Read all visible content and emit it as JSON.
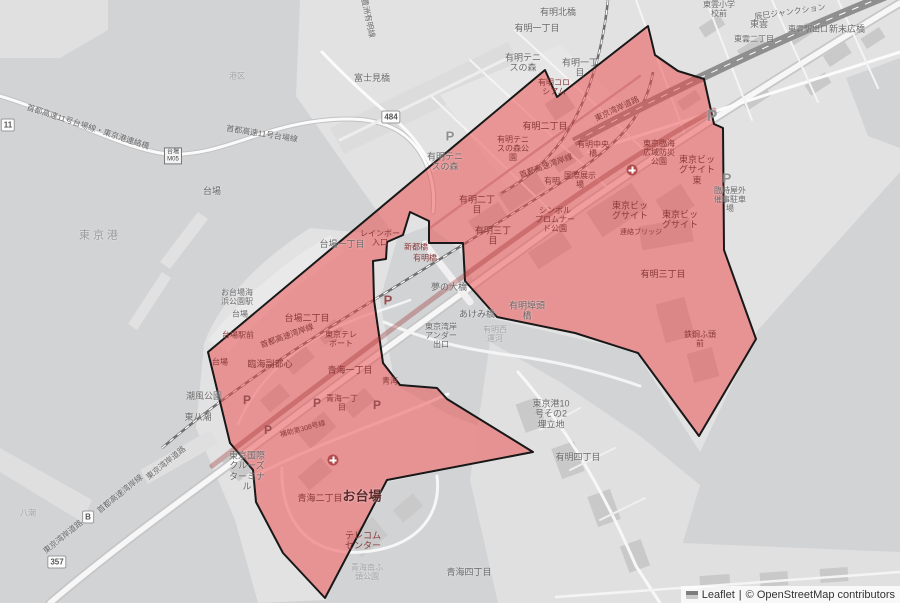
{
  "attribution": {
    "leaflet": "Leaflet",
    "sep": "|",
    "osm": "© OpenStreetMap contributors"
  },
  "highlight_color": "#eb4b4b",
  "labels": [
    {
      "t": "首都高速11号台場線・東京港連絡橋",
      "x": 88,
      "y": 127,
      "s": 8,
      "c": "g",
      "rot": 18
    },
    {
      "t": "首都高速11号台場線",
      "x": 262,
      "y": 134,
      "s": 8,
      "c": "g",
      "rot": 9
    },
    {
      "t": "豊洲有明線",
      "x": 368,
      "y": 18,
      "s": 8,
      "c": "g",
      "rot": 78
    },
    {
      "t": "富士見橋",
      "x": 372,
      "y": 78,
      "s": 9,
      "c": "g"
    },
    {
      "t": "有明北橋",
      "x": 558,
      "y": 12,
      "s": 9,
      "c": "g"
    },
    {
      "t": "有明一丁目",
      "x": 537,
      "y": 28,
      "s": 9,
      "c": "g"
    },
    {
      "t": "有明一丁\n目",
      "x": 580,
      "y": 68,
      "s": 9,
      "c": "g"
    },
    {
      "t": "有明テニ\nスの森",
      "x": 523,
      "y": 63,
      "s": 9,
      "c": "g"
    },
    {
      "t": "有明テニ\nスの森",
      "x": 445,
      "y": 162,
      "s": 9,
      "c": "g"
    },
    {
      "t": "東雲小学\n校前",
      "x": 719,
      "y": 9,
      "s": 8,
      "c": "g"
    },
    {
      "t": "辰巳ジャンクション",
      "x": 790,
      "y": 12,
      "s": 8,
      "c": "g",
      "rot": -8
    },
    {
      "t": "東雲",
      "x": 759,
      "y": 24,
      "s": 9,
      "c": "g"
    },
    {
      "t": "東雲二丁目",
      "x": 754,
      "y": 39,
      "s": 8,
      "c": "g"
    },
    {
      "t": "東雲駅出口",
      "x": 808,
      "y": 29,
      "s": 8,
      "c": "g"
    },
    {
      "t": "新末広橋",
      "x": 847,
      "y": 29,
      "s": 9,
      "c": "g"
    },
    {
      "t": "港区",
      "x": 237,
      "y": 76,
      "s": 8,
      "c": "f"
    },
    {
      "t": "東京港",
      "x": 100,
      "y": 236,
      "s": 11,
      "c": "w"
    },
    {
      "t": "台場",
      "x": 212,
      "y": 191,
      "s": 9,
      "c": "g"
    },
    {
      "t": "台場一丁目",
      "x": 342,
      "y": 244,
      "s": 9,
      "c": "g"
    },
    {
      "t": "お台場海\n浜公園駅",
      "x": 237,
      "y": 297,
      "s": 8,
      "c": "g"
    },
    {
      "t": "台場",
      "x": 240,
      "y": 314,
      "s": 8,
      "c": "g"
    },
    {
      "t": "夢の大橋",
      "x": 449,
      "y": 287,
      "s": 9,
      "c": "g"
    },
    {
      "t": "あけみ橋",
      "x": 477,
      "y": 314,
      "s": 9,
      "c": "g"
    },
    {
      "t": "東京湾岸\nアンダー\n出口",
      "x": 441,
      "y": 336,
      "s": 8,
      "c": "g"
    },
    {
      "t": "有明埠頭\n橋",
      "x": 527,
      "y": 311,
      "s": 9,
      "c": "g"
    },
    {
      "t": "有明西\n運河",
      "x": 495,
      "y": 334,
      "s": 8,
      "c": "f"
    },
    {
      "t": "東京港10\n号その2\n埋立地",
      "x": 551,
      "y": 414,
      "s": 9,
      "c": "g"
    },
    {
      "t": "有明四丁目",
      "x": 578,
      "y": 457,
      "s": 9,
      "c": "g"
    },
    {
      "t": "青海四丁目",
      "x": 469,
      "y": 572,
      "s": 9,
      "c": "g"
    },
    {
      "t": "青海南ふ\n頭公園",
      "x": 367,
      "y": 572,
      "s": 8,
      "c": "f"
    },
    {
      "t": "東京国際\nクルーズ\nターミナ\nル",
      "x": 247,
      "y": 471,
      "s": 9,
      "c": "g"
    },
    {
      "t": "潮風公園",
      "x": 204,
      "y": 396,
      "s": 9,
      "c": "g"
    },
    {
      "t": "東八潮",
      "x": 198,
      "y": 417,
      "s": 9,
      "c": "g"
    },
    {
      "t": "八潮",
      "x": 28,
      "y": 513,
      "s": 8,
      "c": "f"
    },
    {
      "t": "東京湾岸道路",
      "x": 63,
      "y": 537,
      "s": 8,
      "c": "g",
      "rot": -39
    },
    {
      "t": "首都高速湾岸線",
      "x": 120,
      "y": 494,
      "s": 8,
      "c": "g",
      "rot": -39
    },
    {
      "t": "東京湾岸道路",
      "x": 166,
      "y": 463,
      "s": 8,
      "c": "g",
      "rot": -39
    },
    {
      "t": "臨時屋外\n催事駐車\n場",
      "x": 730,
      "y": 200,
      "s": 8,
      "c": "g"
    },
    {
      "t": "有明二丁目",
      "x": 545,
      "y": 126,
      "s": 9,
      "c": "r"
    },
    {
      "t": "有明二丁\n目",
      "x": 477,
      "y": 205,
      "s": 9,
      "c": "r"
    },
    {
      "t": "有明三丁\n目",
      "x": 493,
      "y": 236,
      "s": 9,
      "c": "r"
    },
    {
      "t": "有明三丁目",
      "x": 663,
      "y": 274,
      "s": 9,
      "c": "r"
    },
    {
      "t": "有明テニ\nスの森公\n園",
      "x": 513,
      "y": 149,
      "s": 8,
      "c": "r"
    },
    {
      "t": "有明中央\n橋",
      "x": 593,
      "y": 149,
      "s": 8,
      "c": "r"
    },
    {
      "t": "有明コロ\nシアム",
      "x": 554,
      "y": 87,
      "s": 8,
      "c": "r"
    },
    {
      "t": "東京湾岸道路",
      "x": 617,
      "y": 109,
      "s": 8,
      "c": "r",
      "rot": -25
    },
    {
      "t": "首都高速湾岸線",
      "x": 546,
      "y": 166,
      "s": 8,
      "c": "r",
      "rot": -20
    },
    {
      "t": "首都高速湾岸線",
      "x": 287,
      "y": 336,
      "s": 8,
      "c": "r",
      "rot": -20
    },
    {
      "t": "国際展示\n場",
      "x": 580,
      "y": 180,
      "s": 8,
      "c": "r"
    },
    {
      "t": "有明",
      "x": 552,
      "y": 181,
      "s": 8,
      "c": "r"
    },
    {
      "t": "シンボル\nプロムナー\nド公園",
      "x": 555,
      "y": 220,
      "s": 8,
      "c": "r"
    },
    {
      "t": "東京ビッ\nグサイト",
      "x": 630,
      "y": 211,
      "s": 9,
      "c": "r"
    },
    {
      "t": "東京ビッ\nグサイト",
      "x": 680,
      "y": 220,
      "s": 9,
      "c": "r"
    },
    {
      "t": "東京ビッ\nグサイト\n東",
      "x": 697,
      "y": 170,
      "s": 9,
      "c": "r"
    },
    {
      "t": "東京臨海\n広域防災\n公園",
      "x": 659,
      "y": 153,
      "s": 8,
      "c": "r"
    },
    {
      "t": "連絡ブリッジ",
      "x": 641,
      "y": 233,
      "s": 7,
      "c": "r"
    },
    {
      "t": "鉄鋼ふ頭\n前",
      "x": 700,
      "y": 339,
      "s": 8,
      "c": "r"
    },
    {
      "t": "レインボー\n入口",
      "x": 380,
      "y": 238,
      "s": 8,
      "c": "r"
    },
    {
      "t": "新都橋",
      "x": 416,
      "y": 247,
      "s": 8,
      "c": "r"
    },
    {
      "t": "有明橋",
      "x": 425,
      "y": 258,
      "s": 8,
      "c": "r"
    },
    {
      "t": "台場二丁目",
      "x": 307,
      "y": 318,
      "s": 9,
      "c": "r"
    },
    {
      "t": "東京テレ\nポート",
      "x": 341,
      "y": 339,
      "s": 8,
      "c": "r"
    },
    {
      "t": "台場駅前",
      "x": 238,
      "y": 335,
      "s": 8,
      "c": "r"
    },
    {
      "t": "台場",
      "x": 220,
      "y": 362,
      "s": 8,
      "c": "r"
    },
    {
      "t": "臨海副都心",
      "x": 270,
      "y": 364,
      "s": 9,
      "c": "r"
    },
    {
      "t": "青海一丁目",
      "x": 350,
      "y": 370,
      "s": 9,
      "c": "r"
    },
    {
      "t": "青海一丁\n目",
      "x": 342,
      "y": 403,
      "s": 8,
      "c": "r"
    },
    {
      "t": "青海",
      "x": 390,
      "y": 381,
      "s": 8,
      "c": "r"
    },
    {
      "t": "補助第308号線",
      "x": 303,
      "y": 430,
      "s": 7,
      "c": "r",
      "rot": -15
    },
    {
      "t": "青海二丁目",
      "x": 320,
      "y": 498,
      "s": 9,
      "c": "r"
    },
    {
      "t": "お台場",
      "x": 362,
      "y": 497,
      "s": 13,
      "c": "b"
    },
    {
      "t": "テレコム\nセンター",
      "x": 363,
      "y": 541,
      "s": 9,
      "c": "r"
    }
  ],
  "icons": {
    "parking": [
      {
        "x": 712,
        "y": 117,
        "s": 16,
        "c": "g"
      },
      {
        "x": 727,
        "y": 178,
        "s": 13,
        "c": "g"
      },
      {
        "x": 450,
        "y": 136,
        "s": 13,
        "c": "g"
      },
      {
        "x": 388,
        "y": 300,
        "s": 13,
        "c": "r"
      },
      {
        "x": 247,
        "y": 400,
        "s": 12,
        "c": "r"
      },
      {
        "x": 317,
        "y": 403,
        "s": 12,
        "c": "r"
      },
      {
        "x": 377,
        "y": 405,
        "s": 12,
        "c": "r"
      },
      {
        "x": 268,
        "y": 430,
        "s": 12,
        "c": "r"
      }
    ],
    "hospital": [
      {
        "x": 632,
        "y": 170
      },
      {
        "x": 333,
        "y": 460
      }
    ],
    "shields": [
      {
        "t": "11",
        "x": 8,
        "y": 125
      },
      {
        "t": "484",
        "x": 391,
        "y": 117
      },
      {
        "t": "B",
        "x": 88,
        "y": 517
      },
      {
        "t": "357",
        "x": 57,
        "y": 562
      }
    ],
    "exit_badge": {
      "t": "台場\nM05",
      "x": 173,
      "y": 156
    }
  }
}
